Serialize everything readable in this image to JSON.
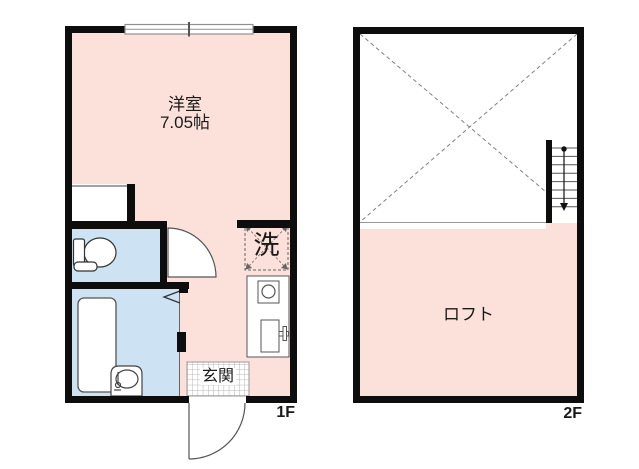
{
  "floor_1f": {
    "floor_label": "1F",
    "room": {
      "name": "洋室",
      "size": "7.05帖"
    },
    "washer_label": "洗",
    "entrance_label": "玄関"
  },
  "floor_2f": {
    "floor_label": "2F",
    "loft_label": "ロフト"
  },
  "colors": {
    "room_fill": "#fbe1da",
    "wet_fill": "#cde2f2",
    "wall": "#0d0d0d"
  }
}
